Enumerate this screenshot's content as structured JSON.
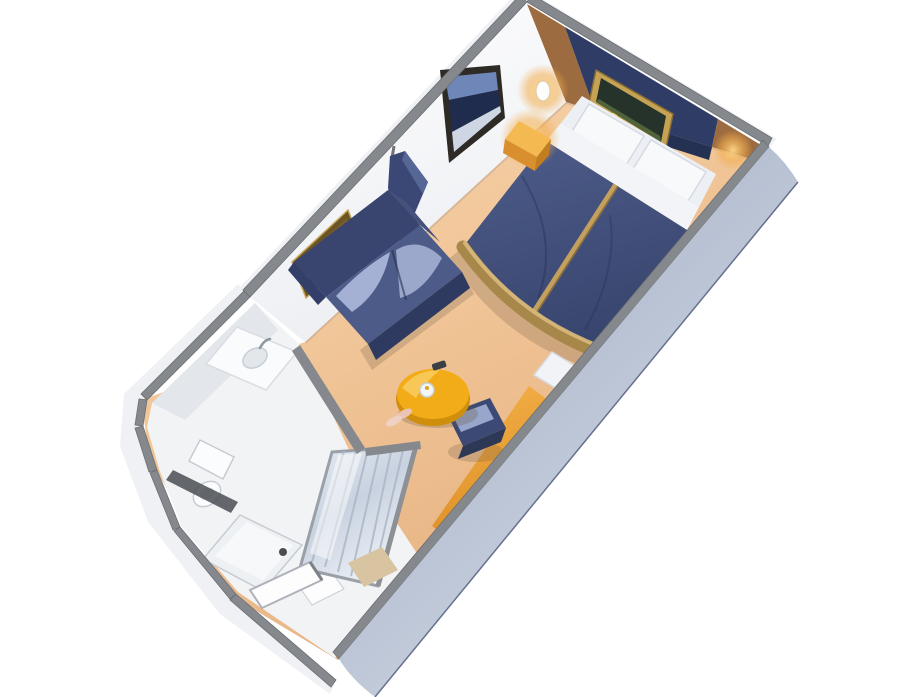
{
  "scene": {
    "type": "isometric-3d-floorplan",
    "subject": "cruise ship stateroom cutaway floor plan",
    "rooms": [
      "bedroom",
      "sitting-area",
      "bathroom",
      "entry-corridor"
    ],
    "furniture": [
      "double-bed",
      "pillows",
      "gold-bed-runner",
      "curved-footboard",
      "nightstand-lamp",
      "wall-sconce",
      "framed-art-above-bed",
      "window-picture",
      "framed-art-above-sofa",
      "privacy-curtain",
      "loveseat-sofa",
      "round-coffee-table",
      "teapot",
      "remote",
      "slippers",
      "vanity-desk",
      "desk-stool",
      "bed-bench",
      "sink-vanity",
      "toilet",
      "shower",
      "shower-glass-panel",
      "entry-door",
      "floor-mat"
    ]
  },
  "colors": {
    "background": "#ffffff",
    "wall_cap": "#85888c",
    "wall_outer_face": "#f0f1f4",
    "wall_inner": "#fdfdfe",
    "accent_wall_navy": "#2e3c66",
    "wood_panel": "#9c6b3f",
    "bathroom_floor": "#f2f3f5",
    "fixture_white": "#fafbfc",
    "fixture_shade": "#e3e7ec",
    "dark_accent": "#4a4d52",
    "glass_mid": "#cdd6e2",
    "panel_frame": "#9aa0a8",
    "duvet": "#44527e",
    "duvet_dark": "#39466f",
    "linen": "#f2f4f7",
    "pillow": "#f8f9fb",
    "gold_trim": "#c3a05e",
    "gold_trim_dark": "#a8874b",
    "gold_trim_light": "#d9ba7c",
    "sofa": "#4d5b88",
    "sofa_back": "#39456f",
    "sofa_front": "#2e3a60",
    "sofa_arm": "#46527c",
    "cushion_highlight": "#a9b6d8",
    "curtain": "#3b4875",
    "curtain_fold": "#2f3a61",
    "table_top": "#f1ac17",
    "table_rim": "#cf8f0c",
    "table_highlight": "#f8cd62",
    "stool": "#3c4974",
    "stool_top": "#97a6cb",
    "stool_front": "#2d3857",
    "desk_amber": "#f4ad42",
    "lamp_body": "#f5b952",
    "lamp_front": "#d98f2e",
    "lamp_side": "#c27d1f",
    "sconce": "#fdfdfb",
    "frame_gold": "#c6a254",
    "frame_dark": "#2e2b27",
    "art_navy": "#1f2c4e",
    "art_sky": "#6f87b8",
    "art_light": "#cdd6e2",
    "art_warm": "#7d5d28",
    "art_warm_dark": "#3a2d14",
    "art_green": "#26332b",
    "art_moon": "#e6cf6f",
    "mat_beige": "#d9c4a2",
    "door_white": "#fdfdfe",
    "toilet_white": "#fbfcfd",
    "bench_white": "#f2f3f6"
  }
}
